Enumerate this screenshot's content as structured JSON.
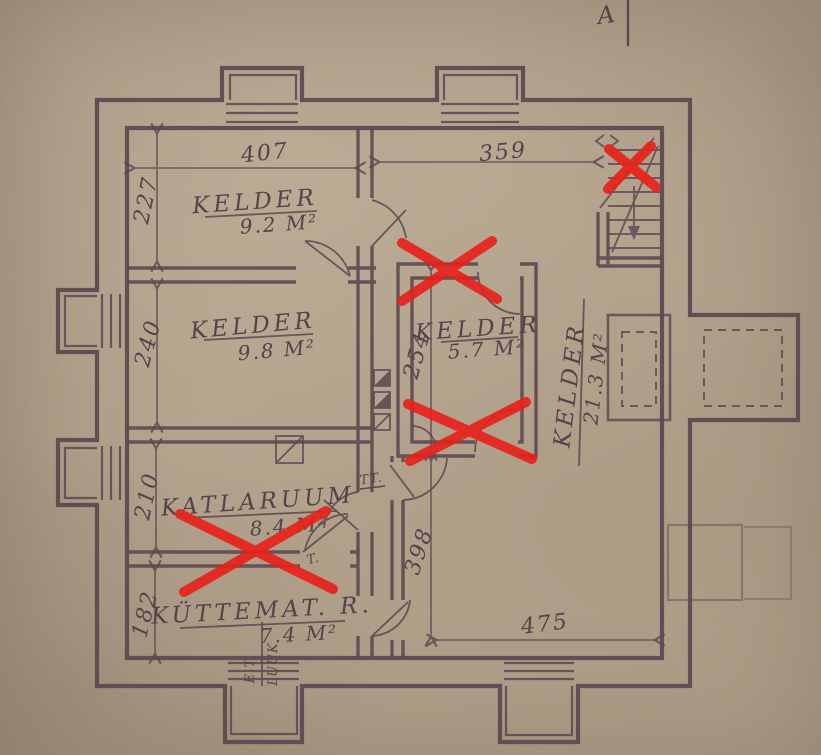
{
  "sheet": {
    "mark_a": "A",
    "type_note": "basement floor plan, hand drawn, scanned",
    "colors": {
      "paper": "#b3a28c",
      "ink": "#5e4550",
      "red_mark": "#e7221b"
    },
    "red_x_marks": {
      "count": 4
    }
  },
  "rooms": [
    {
      "name": "KELDER",
      "area": "9.2 M²"
    },
    {
      "name": "KELDER",
      "area": "9.8 M²"
    },
    {
      "name": "KELDER",
      "area": "5.7 M²"
    },
    {
      "name": "KELDER",
      "area": "21.3 M²"
    },
    {
      "name": "KATLARUUM",
      "area": "8.4 M²"
    },
    {
      "name": "KÜTTEMAT. R.",
      "area": "7.4 M²"
    }
  ],
  "dims": {
    "d407": "407",
    "d359": "359",
    "d227": "227",
    "d240": "240",
    "d210": "210",
    "d182": "182",
    "d254": "254",
    "d398": "398",
    "d475": "475"
  },
  "annotations": {
    "tt": "TT.",
    "t": "T.",
    "et": "E.T.",
    "luuk": "LUUK"
  }
}
